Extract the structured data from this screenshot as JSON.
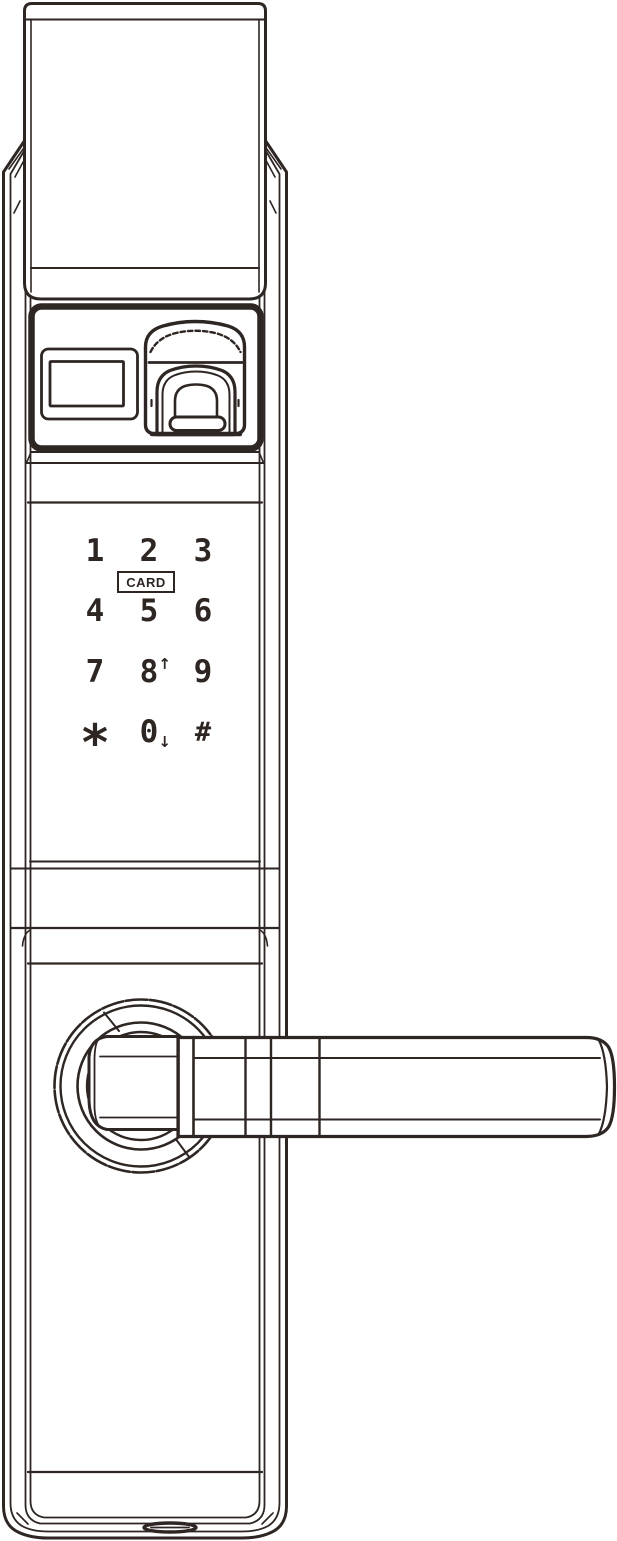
{
  "colors": {
    "ink": "#2e2623",
    "paper": "#ffffff"
  },
  "keypad": {
    "keys": [
      {
        "label": "1"
      },
      {
        "label": "2"
      },
      {
        "label": "3"
      },
      {
        "label": "4"
      },
      {
        "label": "5"
      },
      {
        "label": "6"
      },
      {
        "label": "7"
      },
      {
        "label": "8",
        "arrow": "↑"
      },
      {
        "label": "9"
      },
      {
        "label": "*"
      },
      {
        "label": "0",
        "arrow": "↓"
      },
      {
        "label": "#"
      }
    ],
    "card_label": "CARD"
  }
}
